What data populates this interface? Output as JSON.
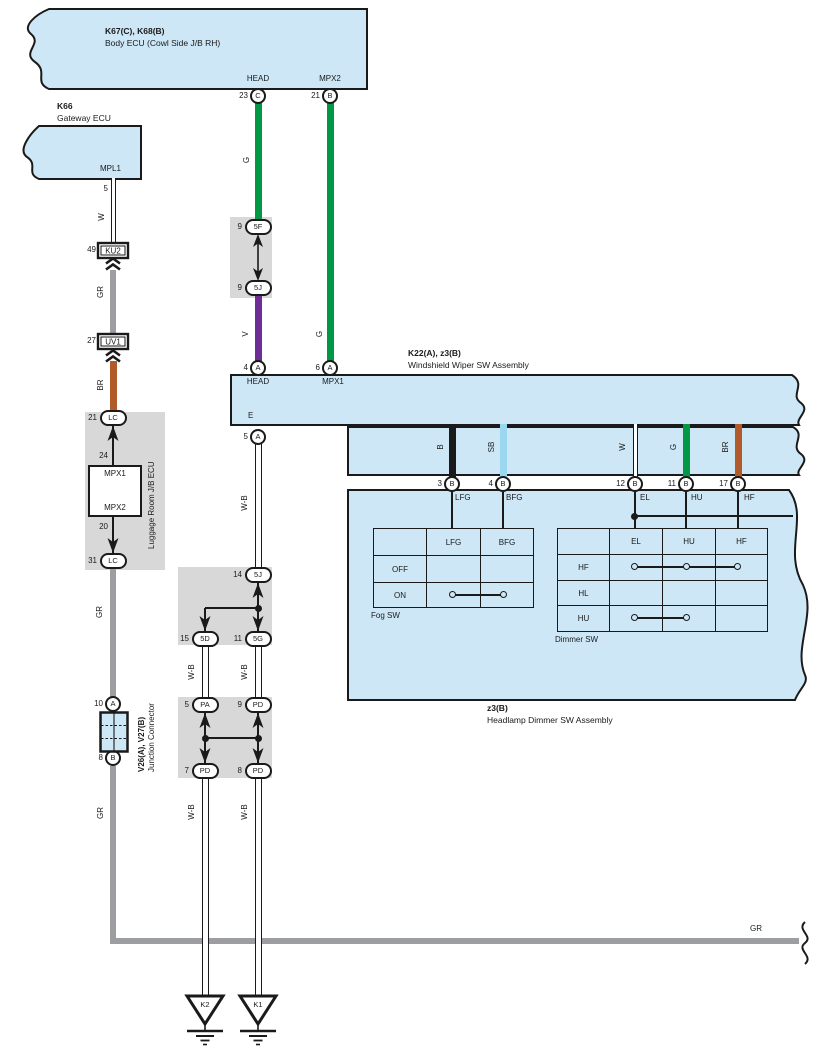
{
  "titles": {
    "body_ecu": {
      "code": "K67(C), K68(B)",
      "name": "Body ECU (Cowl Side J/B RH)"
    },
    "gateway": {
      "code": "K66",
      "name": "Gateway ECU"
    },
    "wiper": {
      "code": "K22(A), z3(B)",
      "name": "Windshield Wiper SW Assembly"
    },
    "headlamp": {
      "code": "z3(B)",
      "name": "Headlamp Dimmer SW Assembly"
    },
    "luggage": {
      "name": "Luggage Room J/B ECU"
    },
    "junction": {
      "code": "V26(A), V27(B)",
      "name": "Junction Connector"
    }
  },
  "ports": {
    "head_top": "HEAD",
    "mpx2_top": "MPX2",
    "mpl1": "MPL1",
    "gw_pin": "5",
    "head_mid": "HEAD",
    "mpx1_mid": "MPX1",
    "e_pin": "E",
    "jb_pin_24": "24",
    "jb_pin_20": "20",
    "jb_mpx1": "MPX1",
    "jb_mpx2": "MPX2",
    "lfg": "LFG",
    "bfg": "BFG",
    "el": "EL",
    "hu": "HU",
    "hf": "HF"
  },
  "connectors": {
    "c23": {
      "num": "23",
      "id": "C"
    },
    "b21": {
      "num": "21",
      "id": "B"
    },
    "a4": {
      "num": "4",
      "id": "A"
    },
    "a6": {
      "num": "6",
      "id": "A"
    },
    "a5": {
      "num": "5",
      "id": "A"
    },
    "b3": {
      "num": "3",
      "id": "B"
    },
    "b4": {
      "num": "4",
      "id": "B"
    },
    "b12": {
      "num": "12",
      "id": "B"
    },
    "b11": {
      "num": "11",
      "id": "B"
    },
    "b17": {
      "num": "17",
      "id": "B"
    },
    "a10": {
      "num": "10",
      "id": "A"
    },
    "b8": {
      "num": "8",
      "id": "B"
    },
    "f5": {
      "num": "9",
      "id": "5F"
    },
    "j5": {
      "num": "9",
      "id": "5J"
    },
    "lc21": {
      "num": "21",
      "id": "LC"
    },
    "lc31": {
      "num": "31",
      "id": "LC"
    },
    "j14": {
      "num": "14",
      "id": "5J"
    },
    "d15": {
      "num": "15",
      "id": "5D"
    },
    "g11": {
      "num": "11",
      "id": "5G"
    },
    "pa5": {
      "num": "5",
      "id": "PA"
    },
    "pd9": {
      "num": "9",
      "id": "PD"
    },
    "pd7": {
      "num": "7",
      "id": "PD"
    },
    "pd8": {
      "num": "8",
      "id": "PD"
    },
    "ku2": {
      "num": "49",
      "id": "KU2"
    },
    "uv1": {
      "num": "27",
      "id": "UV1"
    }
  },
  "wires": {
    "g": "G",
    "v": "V",
    "w": "W",
    "gr": "GR",
    "br": "BR",
    "wb": "W-B",
    "b": "B",
    "sb": "SB"
  },
  "fog_sw": {
    "title": "Fog SW",
    "headers": [
      "",
      "LFG",
      "BFG"
    ],
    "row_labels": [
      "OFF",
      "ON"
    ],
    "contacts": [
      {
        "row": "ON",
        "between": [
          "LFG",
          "BFG"
        ]
      }
    ]
  },
  "dimmer_sw": {
    "title": "Dimmer SW",
    "headers": [
      "",
      "EL",
      "HU",
      "HF"
    ],
    "row_labels": [
      "HF",
      "HL",
      "HU"
    ],
    "contacts": [
      {
        "row": "HF",
        "between": [
          "EL",
          "HU",
          "HF"
        ]
      },
      {
        "row": "HU",
        "between": [
          "EL",
          "HU"
        ]
      }
    ]
  },
  "grounds": {
    "k2": "K2",
    "k1": "K1"
  },
  "colors": {
    "box_fill": "#cde7f6",
    "shade_fill": "#d8d8d8",
    "green": "#009845",
    "violet": "#6f2d96",
    "brown": "#b15a2a",
    "gray": "#9c9ea1",
    "sky_blue": "#9bd7ee",
    "line": "#1a1a1a"
  }
}
